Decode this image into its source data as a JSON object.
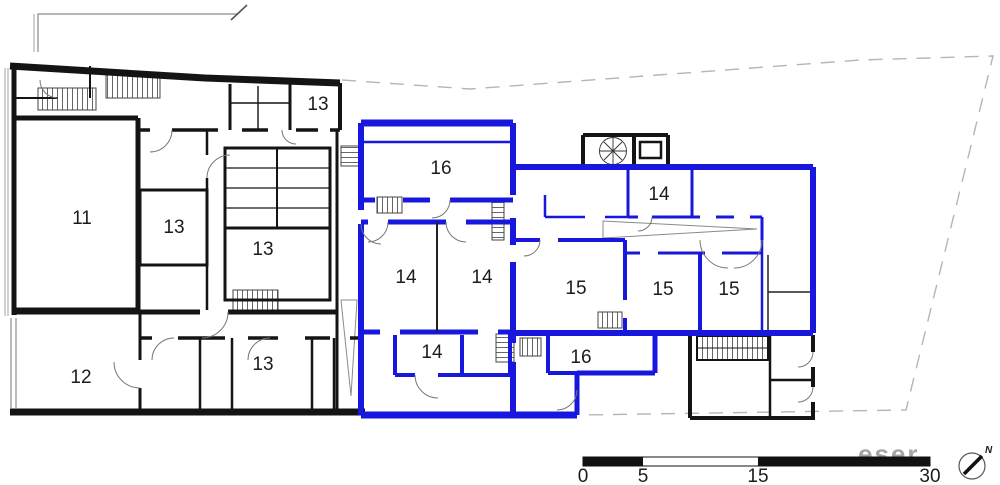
{
  "plan": {
    "colors": {
      "walls": "#141414",
      "highlight": "#1717dd",
      "boundary": "#b5b5b5",
      "thin": "#666666"
    },
    "rooms": [
      {
        "label": "11",
        "x": 82,
        "y": 224
      },
      {
        "label": "13",
        "x": 318,
        "y": 110
      },
      {
        "label": "13",
        "x": 174,
        "y": 233
      },
      {
        "label": "13",
        "x": 263,
        "y": 255
      },
      {
        "label": "13",
        "x": 263,
        "y": 370
      },
      {
        "label": "12",
        "x": 81,
        "y": 383
      },
      {
        "label": "16",
        "x": 441,
        "y": 174
      },
      {
        "label": "14",
        "x": 406,
        "y": 283
      },
      {
        "label": "14",
        "x": 482,
        "y": 283
      },
      {
        "label": "14",
        "x": 659,
        "y": 200
      },
      {
        "label": "15",
        "x": 576,
        "y": 294
      },
      {
        "label": "15",
        "x": 663,
        "y": 295
      },
      {
        "label": "15",
        "x": 729,
        "y": 295
      },
      {
        "label": "14",
        "x": 432,
        "y": 358
      },
      {
        "label": "16",
        "x": 581,
        "y": 363
      }
    ]
  },
  "scale_bar": {
    "ticks": [
      {
        "label": "0",
        "x": 583
      },
      {
        "label": "5",
        "x": 643
      },
      {
        "label": "15",
        "x": 758
      },
      {
        "label": "30",
        "x": 930
      }
    ]
  },
  "north": {
    "label": "N"
  },
  "watermark": {
    "text": "eser"
  }
}
